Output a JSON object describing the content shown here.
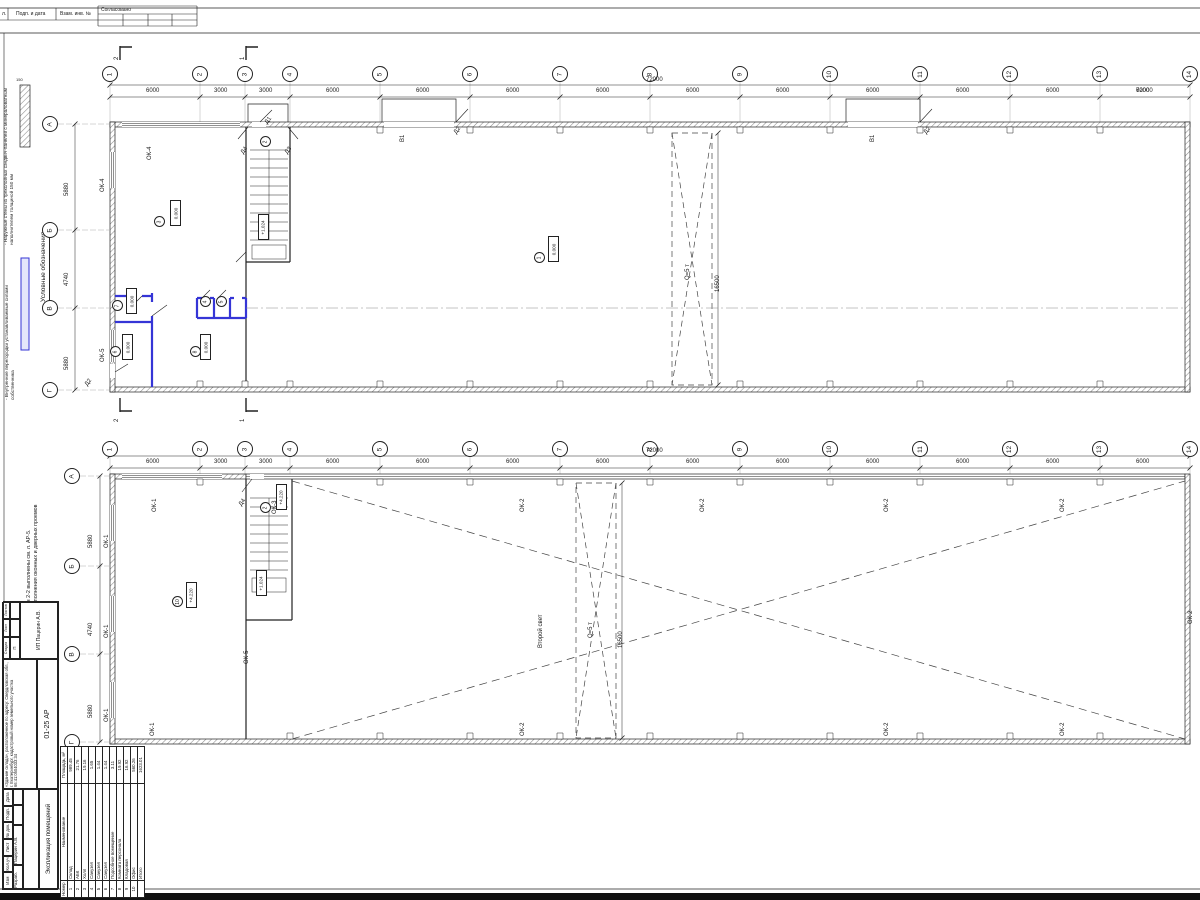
{
  "colors": {
    "line": "#1a1a1a",
    "partition_blue": "#3535d6",
    "hatch": "#8a8a8a"
  },
  "top_stamp": {
    "cell1": "л.",
    "cell2": "Подп. и дата",
    "cell3": "Взам. инв. №",
    "approved": "Согласовано"
  },
  "legend": {
    "title": "Условные обозначения",
    "thickness": "150",
    "item1": "- Наружные стены из трехслойных сэндвич-панелей с минераловатным наполнителем толщиной 150 мм",
    "item2": "- Внутренние перегородки устанавливаемые силами собственника"
  },
  "notes": {
    "line1": "1. Разрез 1-1, Разрез 2-2 выполнены см. л. АР-5.",
    "line2": "2. Спецификация заполнения оконных и дверных проемов"
  },
  "plan1": {
    "axis_circles": [
      {
        "x": 102,
        "y": 66,
        "t": "1"
      },
      {
        "x": 192,
        "y": 66,
        "t": "2"
      },
      {
        "x": 237,
        "y": 66,
        "t": "3"
      },
      {
        "x": 282,
        "y": 66,
        "t": "4"
      },
      {
        "x": 372,
        "y": 66,
        "t": "5"
      },
      {
        "x": 462,
        "y": 66,
        "t": "6"
      },
      {
        "x": 552,
        "y": 66,
        "t": "7"
      },
      {
        "x": 642,
        "y": 66,
        "t": "8"
      },
      {
        "x": 732,
        "y": 66,
        "t": "9"
      },
      {
        "x": 822,
        "y": 66,
        "t": "10"
      },
      {
        "x": 912,
        "y": 66,
        "t": "11"
      },
      {
        "x": 1002,
        "y": 66,
        "t": "12"
      },
      {
        "x": 1092,
        "y": 66,
        "t": "13"
      },
      {
        "x": 1182,
        "y": 66,
        "t": "14"
      }
    ],
    "row_circles": [
      {
        "x": 42,
        "y": 116,
        "t": "А"
      },
      {
        "x": 42,
        "y": 222,
        "t": "Б"
      },
      {
        "x": 42,
        "y": 300,
        "t": "В"
      },
      {
        "x": 42,
        "y": 382,
        "t": "Г"
      }
    ],
    "texts": [
      {
        "x": 146,
        "y": 88,
        "t": "6000"
      },
      {
        "x": 214,
        "y": 88,
        "t": "3000"
      },
      {
        "x": 259,
        "y": 88,
        "t": "3000"
      },
      {
        "x": 326,
        "y": 88,
        "t": "6000"
      },
      {
        "x": 416,
        "y": 88,
        "t": "6000"
      },
      {
        "x": 506,
        "y": 88,
        "t": "6000"
      },
      {
        "x": 596,
        "y": 88,
        "t": "6000"
      },
      {
        "x": 686,
        "y": 88,
        "t": "6000"
      },
      {
        "x": 776,
        "y": 88,
        "t": "6000"
      },
      {
        "x": 866,
        "y": 88,
        "t": "6000"
      },
      {
        "x": 956,
        "y": 88,
        "t": "6000"
      },
      {
        "x": 1046,
        "y": 88,
        "t": "6000"
      },
      {
        "x": 1136,
        "y": 88,
        "t": "72000",
        "hide": ""
      },
      {
        "x": 1136,
        "y": 88,
        "t": "6000"
      },
      {
        "x": 646,
        "y": 77,
        "t": "72000"
      },
      {
        "x": 64,
        "y": 196,
        "t": "5880",
        "r": -90
      },
      {
        "x": 64,
        "y": 286,
        "t": "4740",
        "r": -90
      },
      {
        "x": 64,
        "y": 370,
        "t": "5880",
        "r": -90
      },
      {
        "x": 100,
        "y": 192,
        "t": "ОК-4",
        "r": -90
      },
      {
        "x": 147,
        "y": 160,
        "t": "ОК-4",
        "r": -90
      },
      {
        "x": 100,
        "y": 362,
        "t": "ОК-5",
        "r": -90
      },
      {
        "x": 400,
        "y": 142,
        "t": "В1",
        "r": -90
      },
      {
        "x": 870,
        "y": 142,
        "t": "В1",
        "r": -90
      },
      {
        "x": 264,
        "y": 122,
        "t": "Д1",
        "r": -55
      },
      {
        "x": 240,
        "y": 152,
        "t": "Д4",
        "r": -55
      },
      {
        "x": 284,
        "y": 152,
        "t": "Д3",
        "r": -55
      },
      {
        "x": 453,
        "y": 132,
        "t": "Д2",
        "r": -55
      },
      {
        "x": 923,
        "y": 132,
        "t": "Д2",
        "r": -55
      },
      {
        "x": 84,
        "y": 384,
        "t": "Д2",
        "r": -55
      },
      {
        "x": 685,
        "y": 280,
        "t": "Q=5 т",
        "r": -90
      },
      {
        "x": 715,
        "y": 292,
        "t": "16500",
        "r": -90
      },
      {
        "x": 114,
        "y": 60,
        "t": "2",
        "r": -90
      },
      {
        "x": 240,
        "y": 60,
        "t": "1",
        "r": -90
      },
      {
        "x": 114,
        "y": 422,
        "t": "2",
        "r": -90
      },
      {
        "x": 240,
        "y": 422,
        "t": "1",
        "r": -90
      }
    ],
    "rooms": [
      {
        "x": 154,
        "y": 216,
        "t": "3"
      },
      {
        "x": 260,
        "y": 136,
        "t": "2"
      },
      {
        "x": 534,
        "y": 252,
        "t": "1"
      },
      {
        "x": 112,
        "y": 300,
        "t": "7"
      },
      {
        "x": 110,
        "y": 346,
        "t": "6"
      },
      {
        "x": 190,
        "y": 346,
        "t": "8"
      },
      {
        "x": 200,
        "y": 296,
        "t": "4"
      },
      {
        "x": 216,
        "y": 296,
        "t": "5"
      }
    ],
    "elevs": [
      {
        "x": 170,
        "y": 200,
        "t": "0.000"
      },
      {
        "x": 548,
        "y": 236,
        "t": "0.000"
      },
      {
        "x": 126,
        "y": 288,
        "t": "0.000"
      },
      {
        "x": 122,
        "y": 334,
        "t": "0.000"
      },
      {
        "x": 200,
        "y": 334,
        "t": "0.000"
      },
      {
        "x": 258,
        "y": 214,
        "t": "+1.024"
      }
    ]
  },
  "plan2": {
    "axis_circles": [
      {
        "x": 102,
        "y": 441,
        "t": "1"
      },
      {
        "x": 192,
        "y": 441,
        "t": "2"
      },
      {
        "x": 237,
        "y": 441,
        "t": "3"
      },
      {
        "x": 282,
        "y": 441,
        "t": "4"
      },
      {
        "x": 372,
        "y": 441,
        "t": "5"
      },
      {
        "x": 462,
        "y": 441,
        "t": "6"
      },
      {
        "x": 552,
        "y": 441,
        "t": "7"
      },
      {
        "x": 642,
        "y": 441,
        "t": "8"
      },
      {
        "x": 732,
        "y": 441,
        "t": "9"
      },
      {
        "x": 822,
        "y": 441,
        "t": "10"
      },
      {
        "x": 912,
        "y": 441,
        "t": "11"
      },
      {
        "x": 1002,
        "y": 441,
        "t": "12"
      },
      {
        "x": 1092,
        "y": 441,
        "t": "13"
      },
      {
        "x": 1182,
        "y": 441,
        "t": "14"
      }
    ],
    "row_circles": [
      {
        "x": 64,
        "y": 468,
        "t": "А"
      },
      {
        "x": 64,
        "y": 558,
        "t": "Б"
      },
      {
        "x": 64,
        "y": 646,
        "t": "В"
      },
      {
        "x": 64,
        "y": 734,
        "t": "Г"
      }
    ],
    "texts": [
      {
        "x": 146,
        "y": 459,
        "t": "6000"
      },
      {
        "x": 214,
        "y": 459,
        "t": "3000"
      },
      {
        "x": 259,
        "y": 459,
        "t": "3000"
      },
      {
        "x": 326,
        "y": 459,
        "t": "6000"
      },
      {
        "x": 416,
        "y": 459,
        "t": "6000"
      },
      {
        "x": 506,
        "y": 459,
        "t": "6000"
      },
      {
        "x": 596,
        "y": 459,
        "t": "6000"
      },
      {
        "x": 686,
        "y": 459,
        "t": "6000"
      },
      {
        "x": 776,
        "y": 459,
        "t": "6000"
      },
      {
        "x": 866,
        "y": 459,
        "t": "6000"
      },
      {
        "x": 956,
        "y": 459,
        "t": "6000"
      },
      {
        "x": 1046,
        "y": 459,
        "t": "6000"
      },
      {
        "x": 1136,
        "y": 459,
        "t": "6000"
      },
      {
        "x": 646,
        "y": 448,
        "t": "72000"
      },
      {
        "x": 88,
        "y": 548,
        "t": "5880",
        "r": -90
      },
      {
        "x": 88,
        "y": 636,
        "t": "4740",
        "r": -90
      },
      {
        "x": 88,
        "y": 718,
        "t": "5880",
        "r": -90
      },
      {
        "x": 152,
        "y": 512,
        "t": "ОК-1",
        "r": -90
      },
      {
        "x": 104,
        "y": 548,
        "t": "ОК-1",
        "r": -90
      },
      {
        "x": 104,
        "y": 638,
        "t": "ОК-1",
        "r": -90
      },
      {
        "x": 104,
        "y": 722,
        "t": "ОК-1",
        "r": -90
      },
      {
        "x": 150,
        "y": 736,
        "t": "ОК-1",
        "r": -90
      },
      {
        "x": 272,
        "y": 514,
        "t": "ОК-3",
        "r": -90
      },
      {
        "x": 238,
        "y": 504,
        "t": "Д4",
        "r": -55
      },
      {
        "x": 520,
        "y": 512,
        "t": "ОК-2",
        "r": -90
      },
      {
        "x": 700,
        "y": 512,
        "t": "ОК-2",
        "r": -90
      },
      {
        "x": 884,
        "y": 512,
        "t": "ОК-2",
        "r": -90
      },
      {
        "x": 1060,
        "y": 512,
        "t": "ОК-2",
        "r": -90
      },
      {
        "x": 1188,
        "y": 624,
        "t": "ОК-2",
        "r": -90
      },
      {
        "x": 520,
        "y": 736,
        "t": "ОК-2",
        "r": -90
      },
      {
        "x": 884,
        "y": 736,
        "t": "ОК-2",
        "r": -90
      },
      {
        "x": 1060,
        "y": 736,
        "t": "ОК-2",
        "r": -90
      },
      {
        "x": 244,
        "y": 664,
        "t": "ОК-5",
        "r": -90
      },
      {
        "x": 538,
        "y": 648,
        "t": "Второй свет",
        "r": -90
      },
      {
        "x": 588,
        "y": 638,
        "t": "Q=5 т",
        "r": -90
      },
      {
        "x": 618,
        "y": 648,
        "t": "16500",
        "r": -90
      }
    ],
    "rooms": [
      {
        "x": 172,
        "y": 596,
        "t": "10"
      },
      {
        "x": 260,
        "y": 502,
        "t": "2"
      }
    ],
    "elevs": [
      {
        "x": 186,
        "y": 582,
        "t": "+4.220"
      },
      {
        "x": 276,
        "y": 484,
        "t": "+4.220"
      },
      {
        "x": 256,
        "y": 570,
        "t": "+1.024"
      }
    ]
  },
  "explication": {
    "title": "Экспликация помещений",
    "headers": [
      "Номер помещ.",
      "Наименование",
      "Площадь, м²"
    ],
    "rows": [
      {
        "n": "1",
        "name": "Склад",
        "area": "989.45"
      },
      {
        "n": "2",
        "name": "АБК",
        "area": "21.76"
      },
      {
        "n": "3",
        "name": "Холл",
        "area": "19.16"
      },
      {
        "n": "4",
        "name": "Санузел",
        "area": "1.65"
      },
      {
        "n": "5",
        "name": "Санузел",
        "area": "1.44"
      },
      {
        "n": "6",
        "name": "Санузел",
        "area": "1.44"
      },
      {
        "n": "7",
        "name": "Подсобное помещение",
        "area": "3.11"
      },
      {
        "n": "8",
        "name": "Комната персонала",
        "area": "19.92"
      },
      {
        "n": "9",
        "name": "Кладовая",
        "area": "16.92"
      },
      {
        "n": "10",
        "name": "Офис",
        "area": "560.26"
      },
      {
        "n": "",
        "name": "Итого",
        "area": "1623.01"
      }
    ]
  },
  "stamp": {
    "cols": [
      {
        "t": "Изм"
      },
      {
        "t": "Кол.уч"
      },
      {
        "t": "Лист"
      },
      {
        "t": "№ док."
      },
      {
        "t": "Подп."
      },
      {
        "t": "Дата"
      }
    ],
    "role": "Разраб.",
    "name": "Пацерин А.В.",
    "project": "«Здание склада», расположенное по адресу: Свердловская обл., г. Екатеринбург, кадастровый номер земельного участка 66:41:0504033:34",
    "code": "01-25 АР",
    "stage_label": "Стадия",
    "sheet_label": "Лист",
    "sheets_label": "Листов",
    "stage": "П",
    "company": "ИП Пацерин А.В.",
    "title": "Экспликация помещений"
  }
}
